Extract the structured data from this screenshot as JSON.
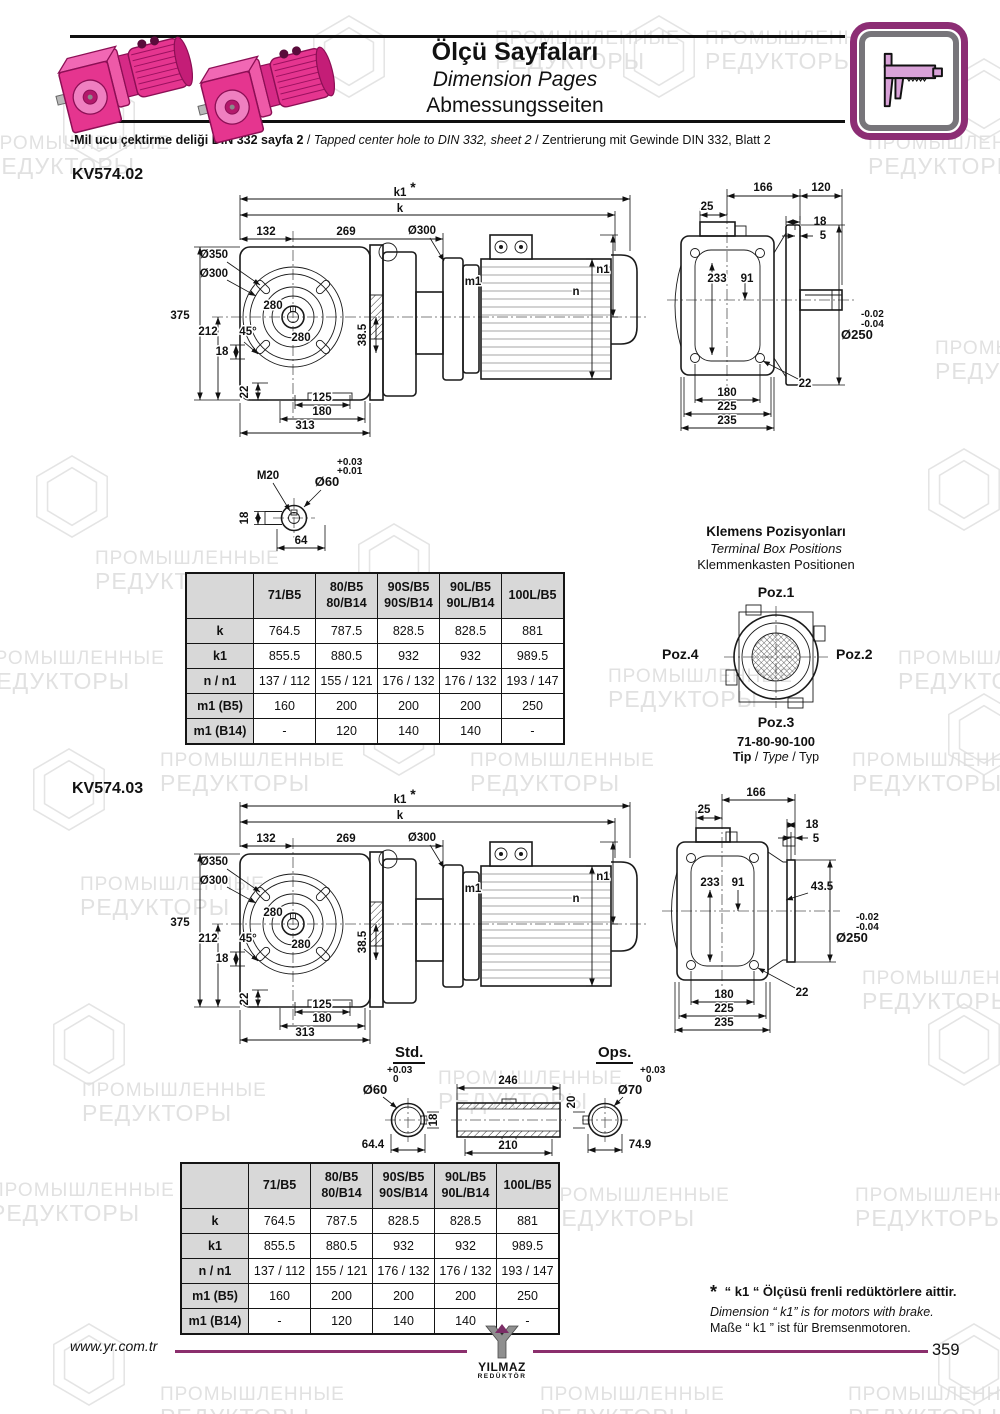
{
  "header": {
    "title_tr": "Ölçü Sayfaları",
    "title_en": "Dimension Pages",
    "title_de": "Abmessungsseiten",
    "note_tr": "-Mil ucu çektirme deliği DIN 332 sayfa 2",
    "note_sep1": "/",
    "note_en": "Tapped center hole to DIN 332, sheet 2",
    "note_sep2": "/",
    "note_de": "Zentrierung mit Gewinde DIN 332, Blatt 2"
  },
  "watermark": {
    "line1": "ПРОМЫШЛЕННЫЕ",
    "line2": "РЕДУКТОРЫ"
  },
  "sections": {
    "kv02": {
      "code": "KV574.02"
    },
    "kv03": {
      "code": "KV574.03"
    }
  },
  "front_dims": {
    "k1": "k1",
    "star": "*",
    "k": "k",
    "d132": "132",
    "d269": "269",
    "d300_motor": "Ø300",
    "d350": "Ø350",
    "d300": "Ø300",
    "d280a": "280",
    "d280b": "280",
    "d375": "375",
    "d212": "212",
    "a45": "45°",
    "d18": "18",
    "d22": "22",
    "d125": "125",
    "d180": "180",
    "d313": "313",
    "d385": "38.5",
    "m1": "m1",
    "n": "n",
    "n1": "n1"
  },
  "sideA_dims": {
    "d166": "166",
    "d120": "120",
    "d25": "25",
    "d18": "18",
    "d5": "5",
    "d233": "233",
    "d91": "91",
    "tol_a": "-0.02",
    "tol_b": "-0.04",
    "d250": "Ø250",
    "d22": "22",
    "d180": "180",
    "d225": "225",
    "d235": "235"
  },
  "sideB_dims": {
    "d166": "166",
    "d25": "25",
    "d18": "18",
    "d5": "5",
    "d233": "233",
    "d91": "91",
    "d435": "43.5",
    "tol_a": "-0.02",
    "tol_b": "-0.04",
    "d250": "Ø250",
    "d22": "22",
    "d180": "180",
    "d225": "225",
    "d235": "235"
  },
  "shaft_detail": {
    "thread": "M20",
    "dia": "Ø60",
    "tol_a": "+0.03",
    "tol_b": "+0.01",
    "key": "18",
    "len": "64"
  },
  "std_ops": {
    "std_label": "Std.",
    "ops_label": "Ops.",
    "std": {
      "dia": "Ø60",
      "tol_a": "+0.03",
      "tol_b": "0",
      "key": "18",
      "len": "64.4"
    },
    "mid": {
      "len_top": "246",
      "len_bottom": "210"
    },
    "ops": {
      "dia": "Ø70",
      "tol_a": "+0.03",
      "tol_b": "0",
      "key": "20",
      "len": "74.9"
    }
  },
  "terminal_box": {
    "title_tr": "Klemens Pozisyonları",
    "title_en": "Terminal Box Positions",
    "title_de": "Klemmenkasten Positionen",
    "poz1": "Poz.1",
    "poz2": "Poz.2",
    "poz3": "Poz.3",
    "poz4": "Poz.4",
    "types": "71-80-90-100",
    "tip_tr": "Tip",
    "tip_sep1": "/",
    "tip_en": "Type",
    "tip_sep2": "/",
    "tip_de": "Typ"
  },
  "dim_table": {
    "col_headers": [
      "71/B5",
      "80/B5\n80/B14",
      "90S/B5\n90S/B14",
      "90L/B5\n90L/B14",
      "100L/B5"
    ],
    "rows": [
      {
        "label": "k",
        "values": [
          "764.5",
          "787.5",
          "828.5",
          "828.5",
          "881"
        ]
      },
      {
        "label": "k1",
        "values": [
          "855.5",
          "880.5",
          "932",
          "932",
          "989.5"
        ]
      },
      {
        "label": "n / n1",
        "values": [
          "137 / 112",
          "155 / 121",
          "176 / 132",
          "176 / 132",
          "193 / 147"
        ]
      },
      {
        "label": "m1 (B5)",
        "values": [
          "160",
          "200",
          "200",
          "200",
          "250"
        ]
      },
      {
        "label": "m1 (B14)",
        "values": [
          "-",
          "120",
          "140",
          "140",
          "-"
        ]
      }
    ]
  },
  "footnote": {
    "star": "*",
    "tr": "“ k1 “ Ölçüsü frenli redüktörlere aittir.",
    "en": "Dimension “ k1” is for motors with brake.",
    "de": "Maße “ k1 ” ist für Bremsenmotoren."
  },
  "footer": {
    "website": "www.yr.com.tr",
    "logo_line1": "YILMAZ",
    "logo_line2": "REDÜKTÖR",
    "page": "359"
  },
  "colors": {
    "accent": "#8c2d74",
    "pink": "#e5358f",
    "table_header_bg": "#d8d8d8",
    "line": "#8b2f6d"
  }
}
